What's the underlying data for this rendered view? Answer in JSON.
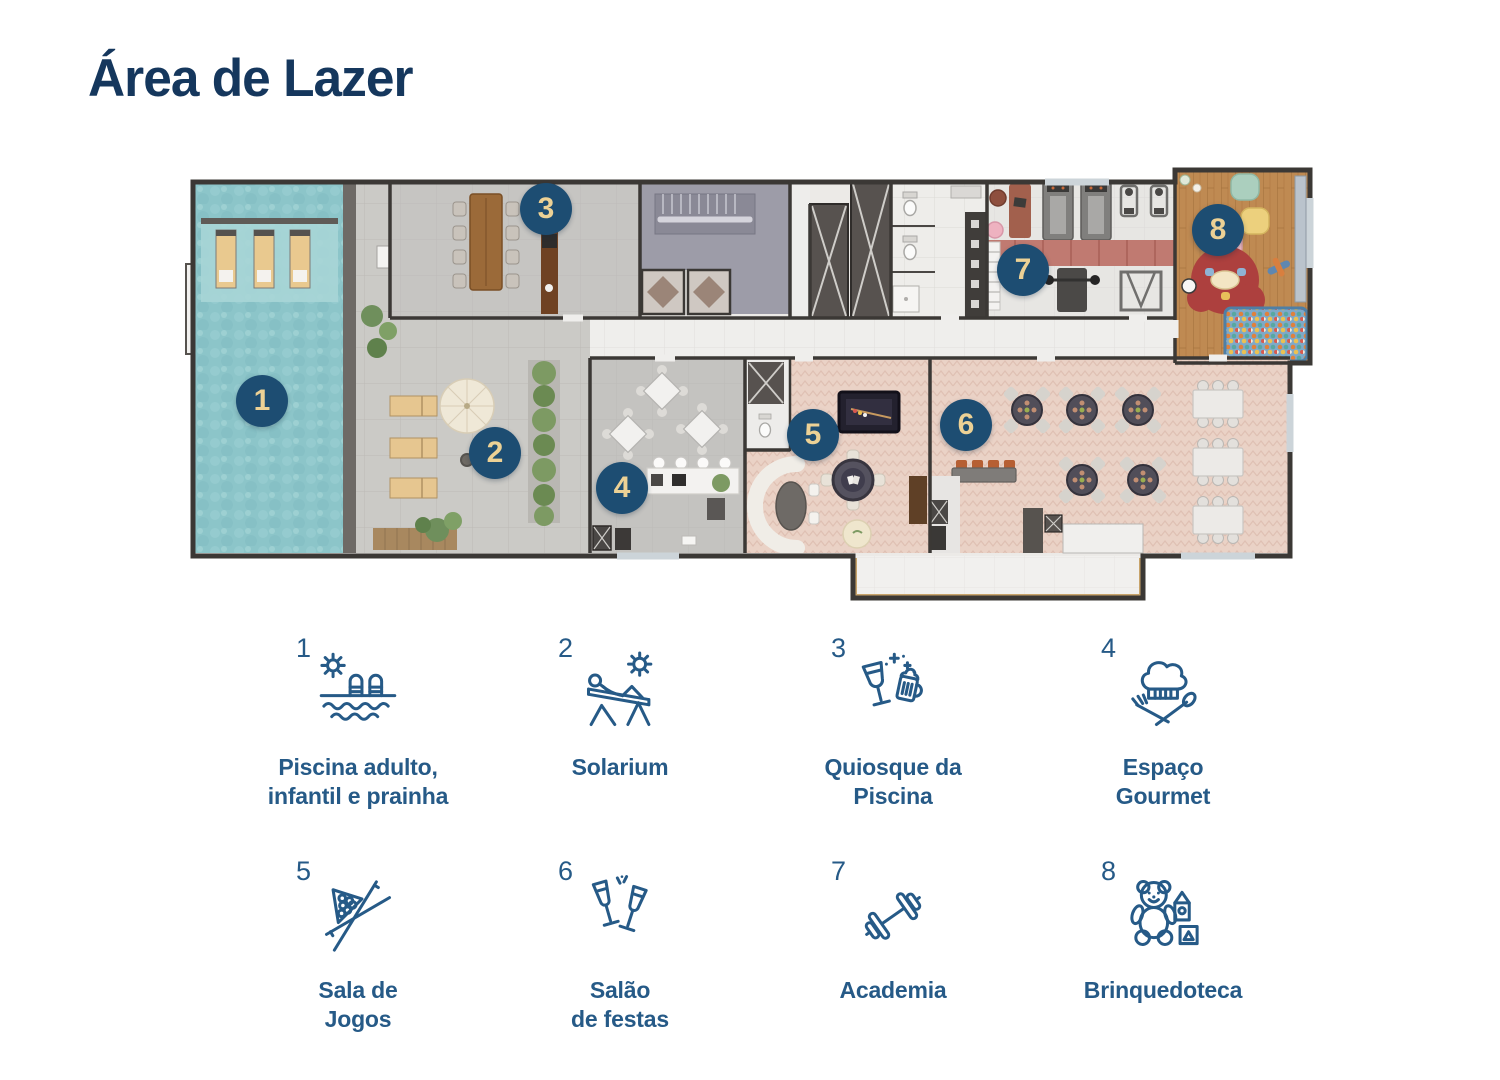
{
  "page": {
    "title": "Área de Lazer"
  },
  "colors": {
    "title_navy": "#15375d",
    "legend_blue": "#265a87",
    "badge_background": "#1d4d72",
    "badge_number_gold": "#ecd195",
    "pool_teal": "#8cc5c9",
    "herringbone_pink": "#ead2c6",
    "wood_floor": "#bf8a52",
    "wall_dark": "#3b3835"
  },
  "plan": {
    "markers": [
      {
        "number": "1",
        "area": "Piscina adulto, infantil e prainha"
      },
      {
        "number": "2",
        "area": "Solarium"
      },
      {
        "number": "3",
        "area": "Quiosque da Piscina"
      },
      {
        "number": "4",
        "area": "Espaço Gourmet"
      },
      {
        "number": "5",
        "area": "Sala de Jogos"
      },
      {
        "number": "6",
        "area": "Salão de festas"
      },
      {
        "number": "7",
        "area": "Academia"
      },
      {
        "number": "8",
        "area": "Brinquedoteca"
      }
    ]
  },
  "legend": {
    "items": [
      {
        "number": "1",
        "icon": "pool-icon",
        "label": "Piscina adulto,\ninfantil e prainha"
      },
      {
        "number": "2",
        "icon": "solarium-icon",
        "label": "Solarium"
      },
      {
        "number": "3",
        "icon": "pool-kiosk-icon",
        "label": "Quiosque da\nPiscina"
      },
      {
        "number": "4",
        "icon": "gourmet-icon",
        "label": "Espaço\nGourmet"
      },
      {
        "number": "5",
        "icon": "game-room-icon",
        "label": "Sala de\nJogos"
      },
      {
        "number": "6",
        "icon": "party-hall-icon",
        "label": "Salão\nde festas"
      },
      {
        "number": "7",
        "icon": "gym-icon",
        "label": "Academia"
      },
      {
        "number": "8",
        "icon": "playroom-icon",
        "label": "Brinquedoteca"
      }
    ]
  }
}
